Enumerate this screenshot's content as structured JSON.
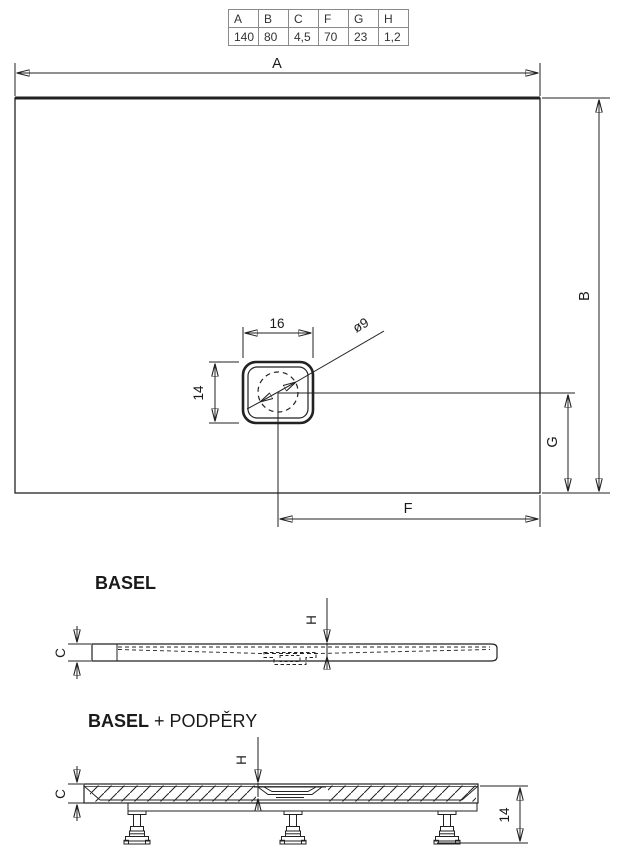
{
  "table": {
    "headers": [
      "A",
      "B",
      "C",
      "F",
      "G",
      "H"
    ],
    "values": [
      "140",
      "80",
      "4,5",
      "70",
      "23",
      "1,2"
    ]
  },
  "top_view": {
    "dim_a": "A",
    "dim_b": "B",
    "dim_f": "F",
    "dim_g": "G",
    "drain_width": "16",
    "drain_depth": "14",
    "drain_diameter": "ø9"
  },
  "basel_view": {
    "title": "BASEL",
    "dim_h": "H",
    "dim_c": "C"
  },
  "podpery_view": {
    "title_bold": "BASEL",
    "title_rest": " + PODPĚRY",
    "dim_h": "H",
    "dim_c": "C",
    "support_height": "14"
  },
  "colors": {
    "line": "#222222",
    "thick_edge": "#5a5a5a",
    "table_border": "#8a8a8a",
    "text": "#1a1a1a"
  }
}
